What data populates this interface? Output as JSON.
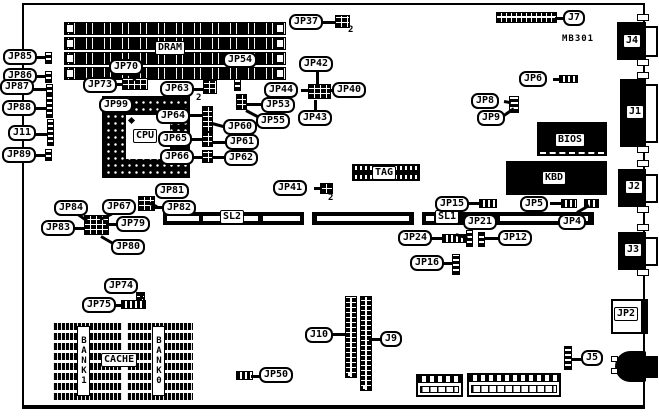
{
  "board": {
    "model": "MB301"
  },
  "labels": {
    "jp85": "JP85",
    "jp86": "JP86",
    "jp87": "JP87",
    "jp88": "JP88",
    "j11": "J11",
    "jp89": "JP89",
    "jp70": "JP70",
    "jp73": "JP73",
    "jp54": "JP54",
    "jp99": "JP99",
    "jp63": "JP63",
    "jp64": "JP64",
    "jp65": "JP65",
    "jp66": "JP66",
    "jp60": "JP60",
    "jp61": "JP61",
    "jp62": "JP62",
    "jp53": "JP53",
    "jp55": "JP55",
    "jp37": "JP37",
    "jp42": "JP42",
    "jp43": "JP43",
    "jp44": "JP44",
    "jp40": "JP40",
    "jp41": "JP41",
    "j7": "J7",
    "jp6": "JP6",
    "jp8": "JP8",
    "jp9": "JP9",
    "jp84": "JP84",
    "jp67": "JP67",
    "jp81": "JP81",
    "jp82": "JP82",
    "jp79": "JP79",
    "jp83": "JP83",
    "jp80": "JP80",
    "sl2": "SL2",
    "sl1": "SL1",
    "jp15": "JP15",
    "jp21": "JP21",
    "jp24": "JP24",
    "jp12": "JP12",
    "jp4": "JP4",
    "jp5": "JP5",
    "jp16": "JP16",
    "jp74": "JP74",
    "jp75": "JP75",
    "j10": "J10",
    "j9": "J9",
    "jp50": "JP50",
    "j5": "J5",
    "jp2": "JP2",
    "j4": "J4",
    "j1": "J1",
    "j2": "J2",
    "j3": "J3"
  },
  "chips": {
    "dram": "DRAM",
    "cpu": "CPU",
    "bios": "BIOS",
    "kbd": "KBD",
    "tag": "TAG",
    "cache": "CACHE",
    "bank1": "BANK1",
    "bank0": "BANK0"
  },
  "annotations": {
    "pin2": "2"
  }
}
